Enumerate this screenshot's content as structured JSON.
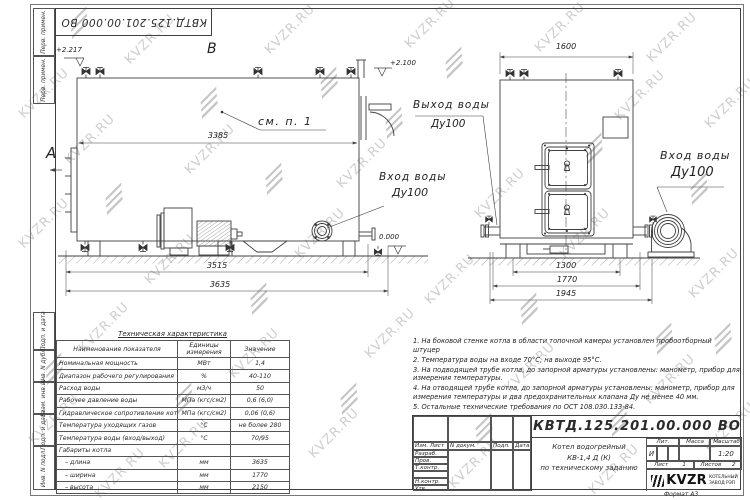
{
  "doc_number": "КВТД.125.201.00.000  ВО",
  "watermark": {
    "text": "KVZR.RU"
  },
  "frame": {
    "left_labels": [
      "Перв. примен.",
      "Перв. примен.",
      "Подп. и дата",
      "Инв. N дубл.",
      "Взам. инв. N",
      "Подп. и дата",
      "Инв. N подл."
    ]
  },
  "views": {
    "side": {
      "label_b": "В",
      "label_a": "А",
      "elev_left": "+2.217",
      "elev_right": "+2.100",
      "elev_zero": "0.000",
      "see_note": "см. п. 1",
      "dim_inner": "3385",
      "dim_mid": "3515",
      "dim_total": "3635",
      "inlet_label": "Вход воды",
      "inlet_dn": "Ду100"
    },
    "end": {
      "dim_top": "1600",
      "dim_b1": "1300",
      "dim_b2": "1770",
      "dim_b3": "1945",
      "outlet_label": "Выход воды",
      "outlet_dn": "Ду100",
      "inlet_label": "Вход воды",
      "inlet_dn": "Ду100"
    }
  },
  "spec_table": {
    "title": "Техническая характеристика",
    "headers": [
      "Наименование показателя",
      "Единицы измерения",
      "Значение"
    ],
    "rows": [
      {
        "name": "Номинальная мощность",
        "unit": "МВт",
        "value": "1,4"
      },
      {
        "name": "Диапазон рабочего регулирования",
        "unit": "%",
        "value": "40-110"
      },
      {
        "name": "Расход воды",
        "unit": "м3/ч",
        "value": "50"
      },
      {
        "name": "Рабочее давление воды",
        "unit": "МПа (кгс/см2)",
        "value": "0,6 (6,0)"
      },
      {
        "name": "Гидравлическое сопротивление котла",
        "unit": "МПа (кгс/см2)",
        "value": "0,06 (0,6)"
      },
      {
        "name": "Температура уходящих газов",
        "unit": "°С",
        "value": "не более 280"
      },
      {
        "name": "Температура воды (вход/выход)",
        "unit": "°С",
        "value": "70/95"
      },
      {
        "name": "Габариты котла",
        "unit": "",
        "value": ""
      },
      {
        "name": "– длина",
        "unit": "мм",
        "value": "3635"
      },
      {
        "name": "– ширина",
        "unit": "мм",
        "value": "1770"
      },
      {
        "name": "– высота",
        "unit": "мм",
        "value": "2150"
      }
    ]
  },
  "notes": {
    "items": [
      "1.  На боковой стенке котла в области топочной камеры установлен пробоотборный штуцер",
      "2.  Температура воды на входе 70°С, на выходе 95°С.",
      "3.  На подводящей трубе котла, до запорной арматуры установлены: манометр, прибор для измерения температуры.",
      "4.  На отводящей трубе котла, до запорной арматуры установлены: манометр, прибор для измерения температуры и два предохранительных клапана Ду не менее 40 мм.",
      "5.  Остальные технические требования по ОСТ 108.030.133-84."
    ]
  },
  "title_block": {
    "doc_number": "КВТД.125.201.00.000  ВО",
    "rev_headers": [
      "Изм. Лист",
      "N докум.",
      "Подп.",
      "Дата"
    ],
    "sign_rows": [
      "Разраб.",
      "Пров.",
      "Т.контр.",
      "",
      "Н.контр.",
      "Утв."
    ],
    "name_line1": "Котел водогрейный",
    "name_line2": "КВ-1,4   Д (К)",
    "name_line3": "по техническому заданию",
    "lit_header": "Лит.",
    "mass_header": "Масса",
    "scale_header": "Масштаб",
    "lit_value": "И",
    "scale_value": "1:20",
    "sheet_label": "Лист",
    "sheet_value": "1",
    "sheets_label": "Листов",
    "sheets_value": "2",
    "logo_text": "KVZR",
    "logo_sub1": "КОТЕЛЬНЫЙ",
    "logo_sub2": "ЗАВОД РЭП",
    "format_label": "Формат   А3"
  }
}
